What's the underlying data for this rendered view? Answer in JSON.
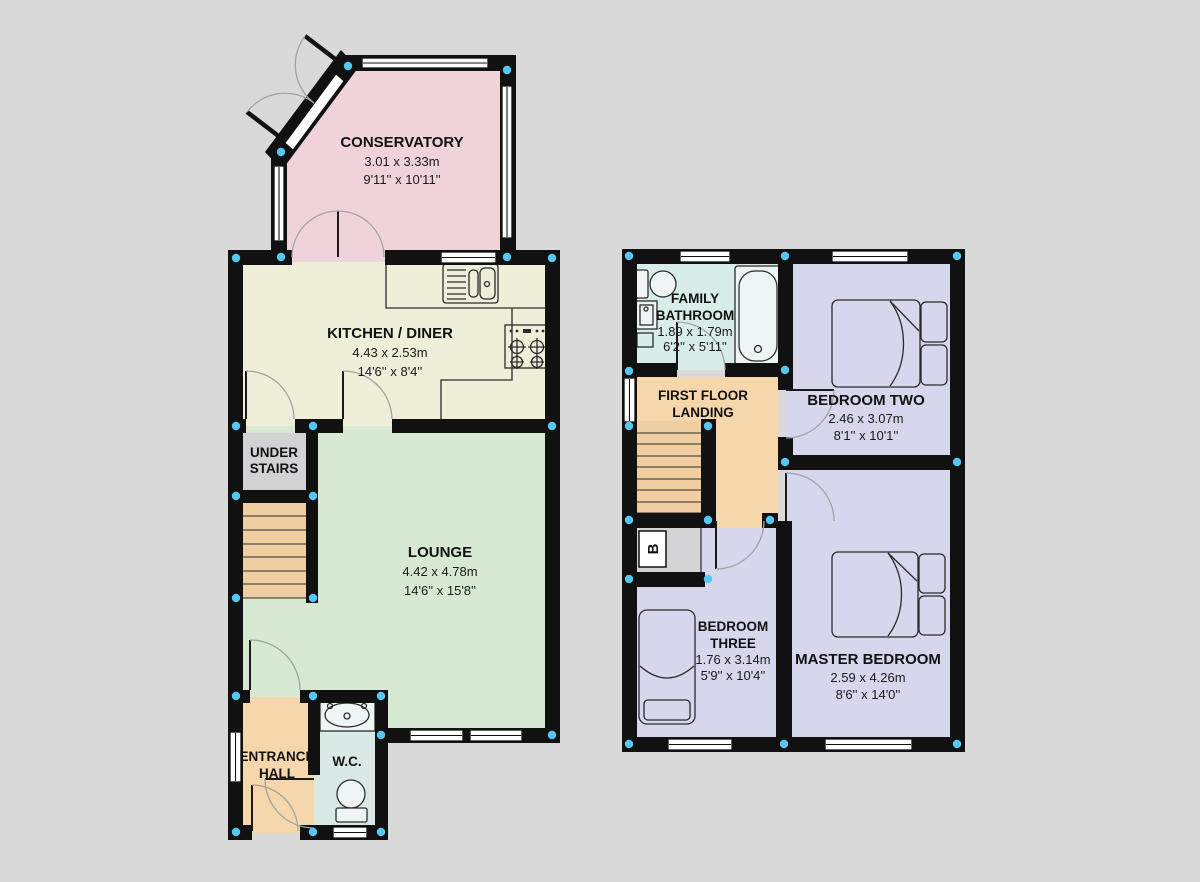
{
  "colors": {
    "background": "#d9d9d9",
    "wall": "#111111",
    "corner_dot": "#56c7f2",
    "window": "#ffffff",
    "conservatory": "#f0d3d9",
    "kitchen": "#eeeed9",
    "lounge": "#d7e9d2",
    "under_stairs": "#d2d2d4",
    "stairs": "#efcfa1",
    "hall": "#f5d7ab",
    "landing": "#f5d7ab",
    "wc": "#d8e9e6",
    "bathroom": "#d8ecea",
    "bedroom": "#d6d7ec",
    "boiler_cupboard": "#d4d4d6"
  },
  "ground_floor": {
    "conservatory": {
      "name": "CONSERVATORY",
      "metric": "3.01 x 3.33m",
      "imperial": "9'11'' x 10'11''"
    },
    "kitchen": {
      "name": "KITCHEN / DINER",
      "metric": "4.43 x 2.53m",
      "imperial": "14'6'' x 8'4''"
    },
    "lounge": {
      "name": "LOUNGE",
      "metric": "4.42 x 4.78m",
      "imperial": "14'6'' x 15'8''"
    },
    "under_stairs": {
      "line1": "UNDER",
      "line2": "STAIRS"
    },
    "entrance_hall": {
      "line1": "ENTRANCE",
      "line2": "HALL"
    },
    "wc": {
      "name": "W.C."
    }
  },
  "first_floor": {
    "bathroom": {
      "line1": "FAMILY",
      "line2": "BATHROOM",
      "metric": "1.89 x 1.79m",
      "imperial": "6'2'' x 5'11''"
    },
    "landing": {
      "line1": "FIRST FLOOR",
      "line2": "LANDING"
    },
    "bedroom_two": {
      "name": "BEDROOM TWO",
      "metric": "2.46 x 3.07m",
      "imperial": "8'1'' x 10'1''"
    },
    "bedroom_three": {
      "line1": "BEDROOM",
      "line2": "THREE",
      "metric": "1.76 x 3.14m",
      "imperial": "5'9'' x 10'4''"
    },
    "master_bedroom": {
      "name": "MASTER BEDROOM",
      "metric": "2.59 x 4.26m",
      "imperial": "8'6'' x 14'0''"
    },
    "boiler": {
      "label": "B"
    }
  }
}
